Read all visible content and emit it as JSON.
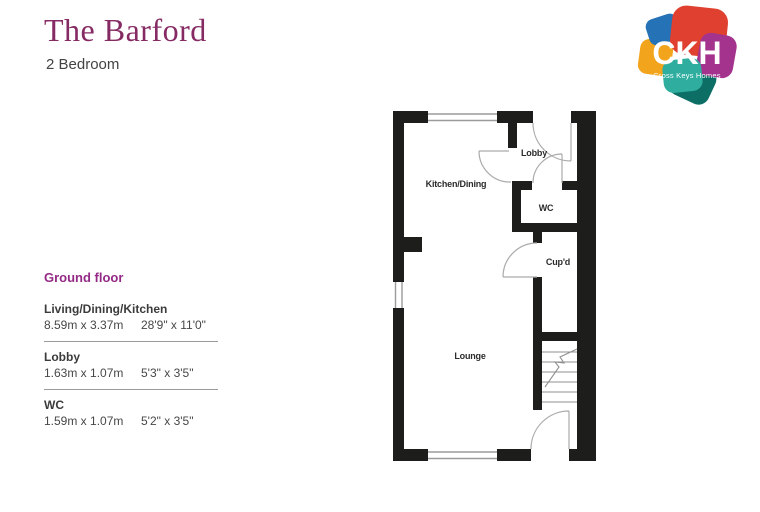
{
  "header": {
    "title": "The Barford",
    "subtitle": "2 Bedroom"
  },
  "logo": {
    "text": "CKH",
    "tagline": "Cross Keys Homes",
    "colors": {
      "blue": "#2572b7",
      "red": "#e0402f",
      "orange": "#f2a51c",
      "purple": "#a4338e",
      "teal": "#2fae9f",
      "dark_teal": "#0d6e66"
    }
  },
  "dimensions_table": {
    "section_label": "Ground floor",
    "rows": [
      {
        "room": "Living/Dining/Kitchen",
        "metric": "8.59m x 3.37m",
        "imperial": "28'9\" x 11'0\""
      },
      {
        "room": "Lobby",
        "metric": "1.63m x 1.07m",
        "imperial": "5'3\" x 3'5\""
      },
      {
        "room": "WC",
        "metric": "1.59m x 1.07m",
        "imperial": "5'2\" x 3'5\""
      }
    ]
  },
  "floorplan": {
    "wall_color": "#1d1d1b",
    "rooms": [
      {
        "label": "Kitchen/Dining"
      },
      {
        "label": "Lobby"
      },
      {
        "label": "WC"
      },
      {
        "label": "Cup'd"
      },
      {
        "label": "Lounge"
      }
    ]
  }
}
